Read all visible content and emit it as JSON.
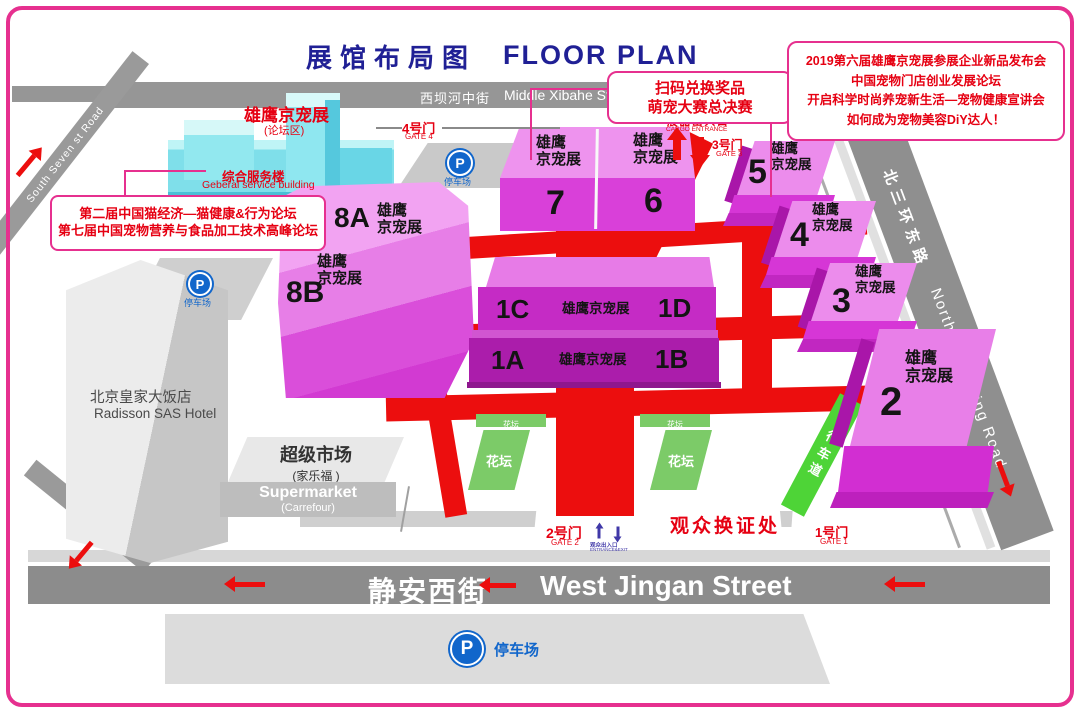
{
  "title": {
    "zh": "展馆布局图",
    "en": "FLOOR PLAN"
  },
  "streets": {
    "xibahe_zh": "西坝河中街",
    "xibahe_en": "Middle Xibahe Street",
    "south_seven": "South Seven st Road",
    "ring_zh": "北三环东路",
    "ring_en": "North Third Ring Road",
    "jingan_zh": "静安西街",
    "jingan_en": "West Jingan Street"
  },
  "callouts": {
    "left1": "第二届中国猫经济—猫健康&行为论坛",
    "left2": "第七届中国宠物营养与食品加工技术高峰论坛",
    "mid1": "扫码兑换奖品",
    "mid2": "萌宠大赛总决赛",
    "right1": "2019第六届雄鹰京宠展参展企业新品发布会",
    "right2": "中国宠物门店创业发展论坛",
    "right3": "开启科学时尚养宠新生活—宠物健康宣讲会",
    "right4": "如何成为宠物美容DiY达人！"
  },
  "forum_area": {
    "brand": "雄鹰京宠展",
    "sub": "(论坛区)",
    "bldg_zh": "综合服务楼",
    "bldg_en": "Geberal service building"
  },
  "brand": {
    "full": "雄鹰京宠展",
    "l1": "雄鹰",
    "l2": "京宠展"
  },
  "halls": {
    "h8a": "8A",
    "h8b": "8B",
    "h7": "7",
    "h6": "6",
    "h5": "5",
    "h4": "4",
    "h3": "3",
    "h2": "2",
    "h1a": "1A",
    "h1b": "1B",
    "h1c": "1C",
    "h1d": "1D"
  },
  "gates": {
    "g4_zh": "4号门",
    "g4_en": "GATE 4",
    "g3_zh": "3号门",
    "g3_en": "GATE 3",
    "g2_zh": "2号门",
    "g2_en": "GATE 2",
    "g1_zh": "1号门",
    "g1_en": "GATE 1"
  },
  "cargo": {
    "zh": "展品出入口",
    "en": "CARGO ENTRANCE"
  },
  "badge_office": "观众换证处",
  "entrance": {
    "zh": "观众出入口",
    "en": "ENTRANCE&EXIT"
  },
  "parking": {
    "label": "停车场",
    "icon": "P"
  },
  "hotel": {
    "zh": "北京皇家大饭店",
    "en": "Radisson SAS Hotel"
  },
  "supermarket": {
    "zh": "超级市场",
    "zh_sub": "(家乐福 )",
    "en": "Supermarket",
    "en_sub": "(Carrefour)"
  },
  "flower": "花坛",
  "lane": "行车道",
  "colors": {
    "accent": "#E6308F",
    "red_text": "#E60012",
    "road_red": "#EC0E0E",
    "blue": "#1166CB",
    "title_blue": "#202095"
  }
}
